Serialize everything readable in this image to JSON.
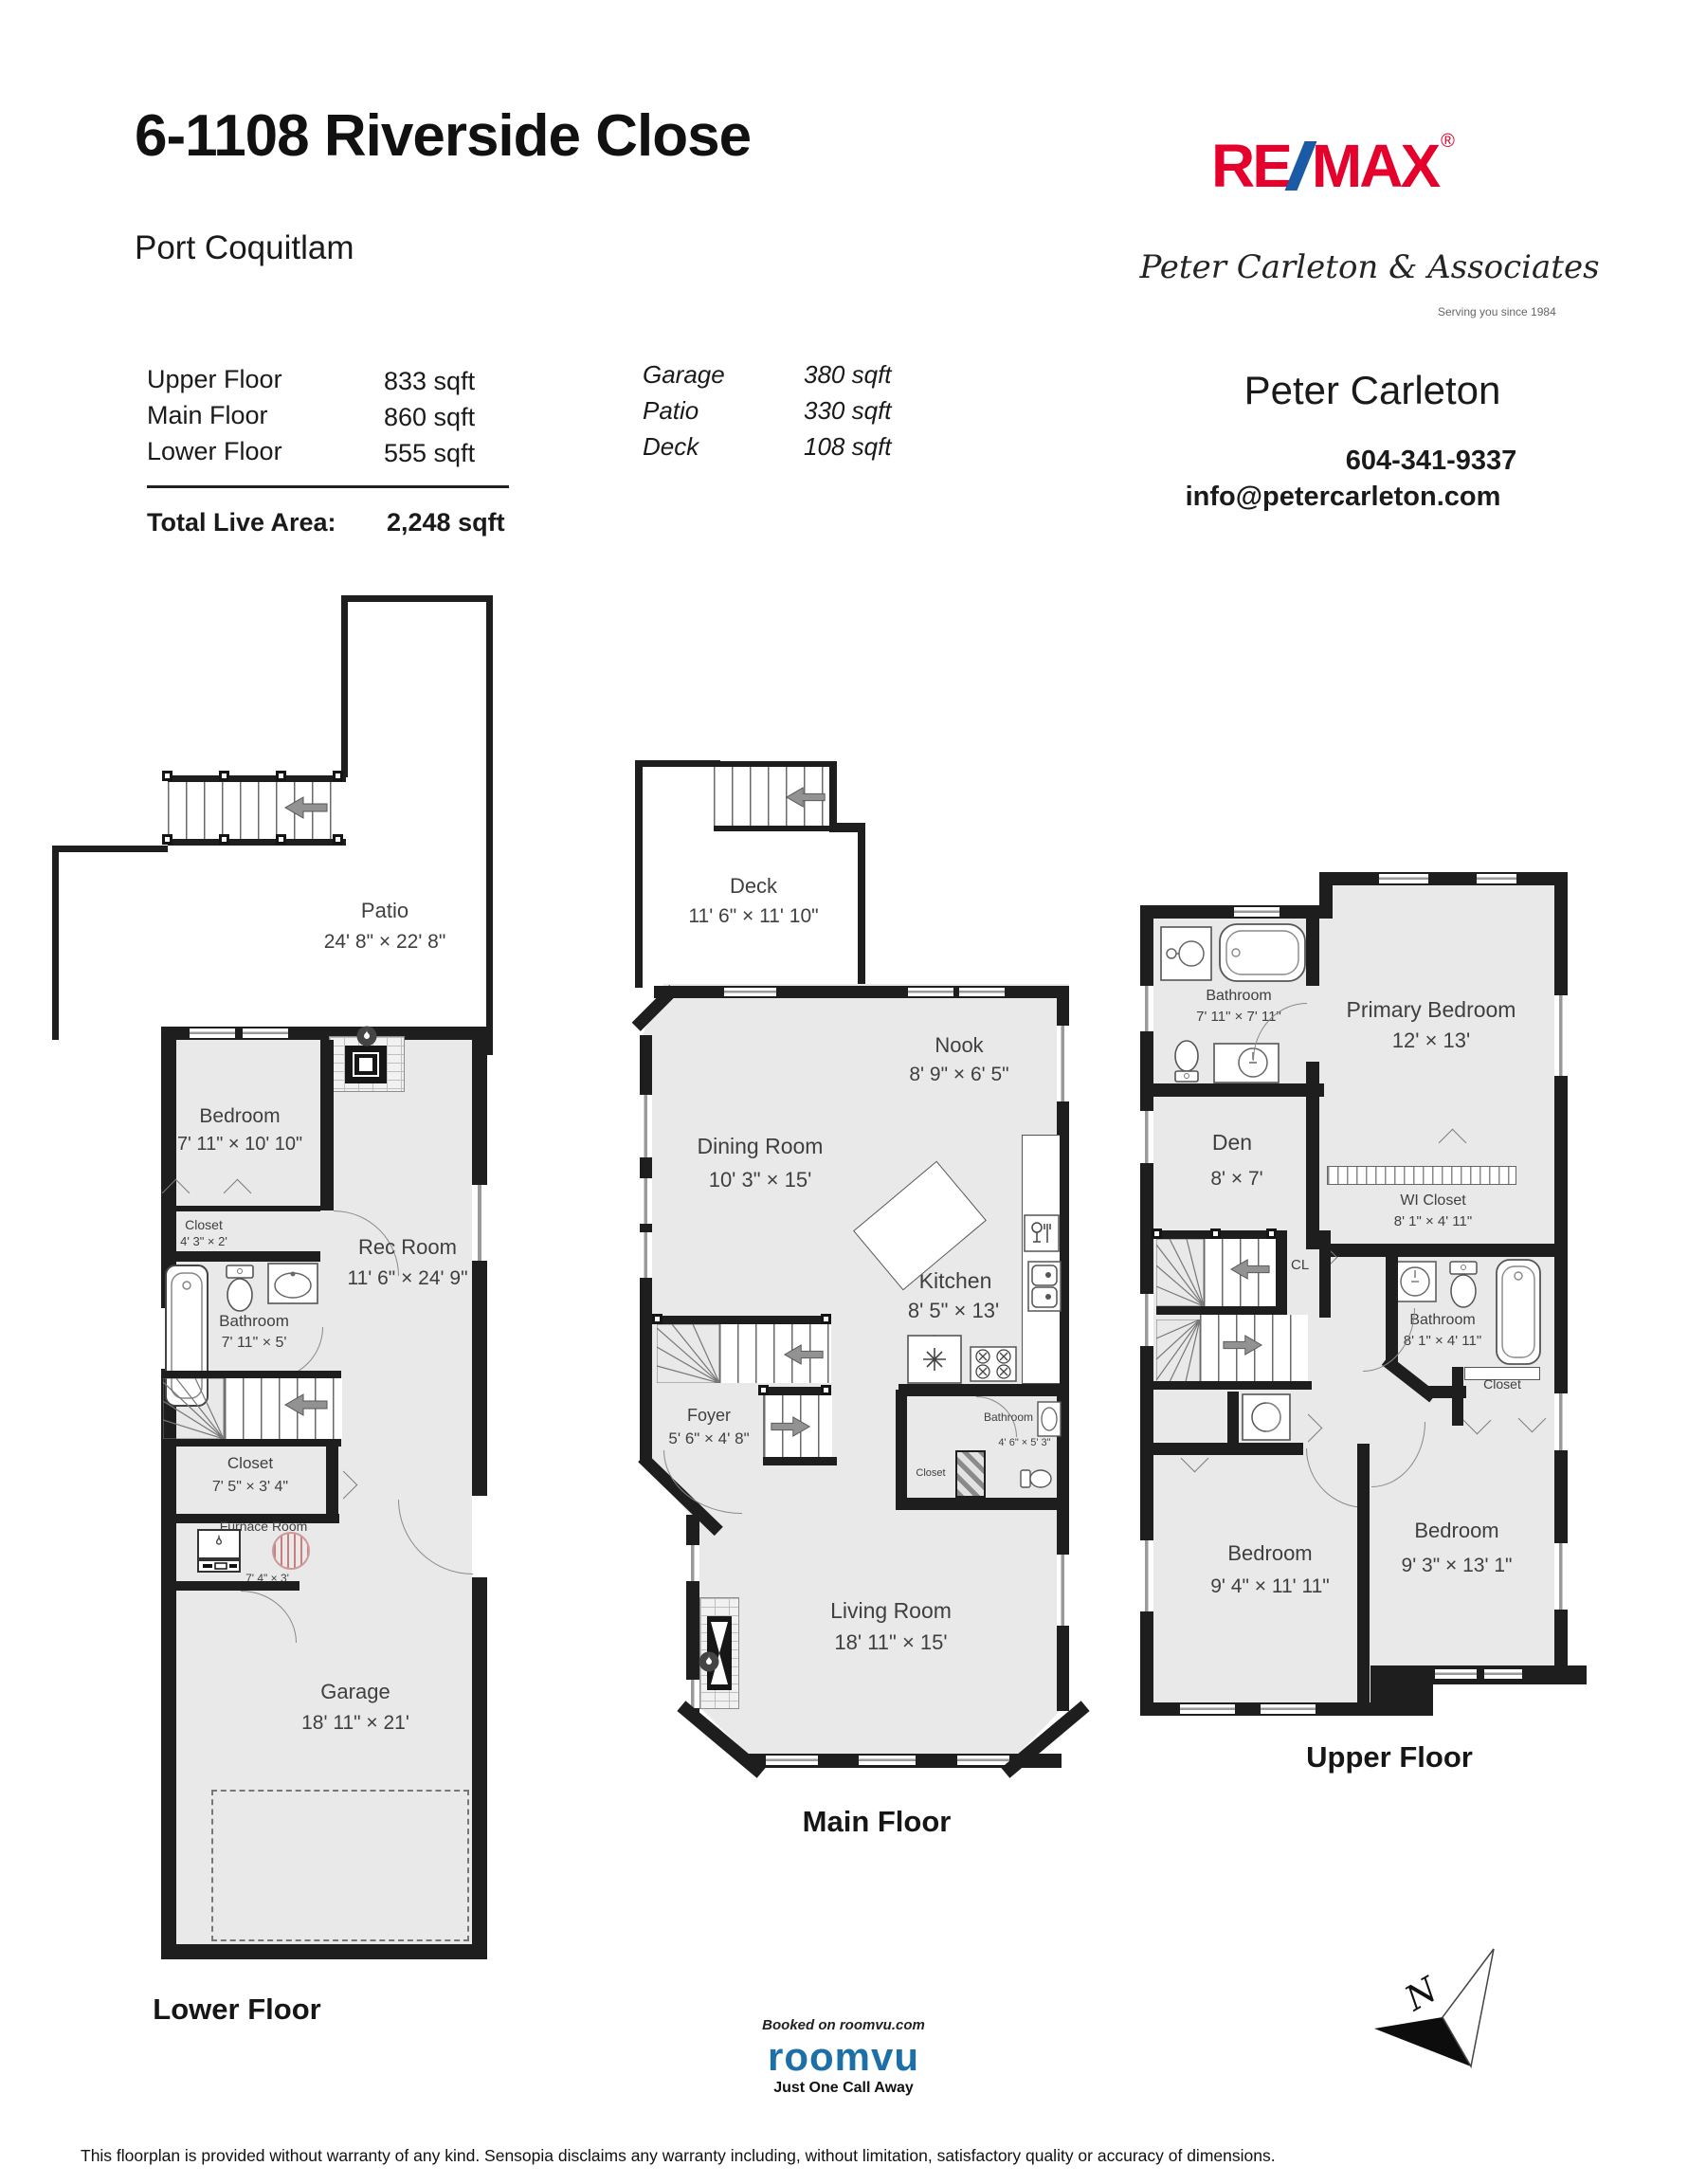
{
  "header": {
    "title": "6-1108 Riverside Close",
    "city": "Port Coquitlam",
    "area_rows_left": [
      {
        "label": "Upper Floor",
        "value": "833 sqft"
      },
      {
        "label": "Main Floor",
        "value": "860 sqft"
      },
      {
        "label": "Lower Floor",
        "value": "555 sqft"
      }
    ],
    "area_rows_right": [
      {
        "label": "Garage",
        "value": "380 sqft"
      },
      {
        "label": "Patio",
        "value": "330 sqft"
      },
      {
        "label": "Deck",
        "value": "108 sqft"
      }
    ],
    "total_label": "Total Live Area:",
    "total_value": "2,248 sqft"
  },
  "brand": {
    "remax_re": "RE",
    "remax_max": "MAX",
    "registered": "®",
    "signature": "Peter Carleton & Associates",
    "signature_tagline": "Serving you since 1984",
    "agent_name": "Peter Carleton",
    "agent_phone": "604-341-9337",
    "agent_email": "info@petercarleton.com",
    "colors": {
      "remax_red": "#e4012c",
      "remax_blue": "#1b5ba5",
      "roomvu_blue": "#1d6fa8"
    }
  },
  "floors": {
    "lower": {
      "label": "Lower Floor",
      "rooms": [
        {
          "name": "Patio",
          "dims": "24' 8\" × 22' 8\""
        },
        {
          "name": "Bedroom",
          "dims": "7' 11\" × 10' 10\""
        },
        {
          "name": "Closet",
          "dims": "4' 3\" × 2'"
        },
        {
          "name": "Rec Room",
          "dims": "11' 6\" × 24' 9\""
        },
        {
          "name": "Bathroom",
          "dims": "7' 11\" × 5'"
        },
        {
          "name": "Closet",
          "dims": "7' 5\" × 3' 4\""
        },
        {
          "name": "Furnace Room",
          "dims": "7' 4\" × 3'"
        },
        {
          "name": "Garage",
          "dims": "18' 11\" × 21'"
        }
      ]
    },
    "main": {
      "label": "Main Floor",
      "rooms": [
        {
          "name": "Deck",
          "dims": "11' 6\" × 11' 10\""
        },
        {
          "name": "Nook",
          "dims": "8' 9\" × 6' 5\""
        },
        {
          "name": "Dining Room",
          "dims": "10' 3\" × 15'"
        },
        {
          "name": "Kitchen",
          "dims": "8' 5\" × 13'"
        },
        {
          "name": "Foyer",
          "dims": "5' 6\" × 4' 8\""
        },
        {
          "name": "Bathroom",
          "dims": "4' 6\" × 5' 3\""
        },
        {
          "name": "Closet",
          "dims": ""
        },
        {
          "name": "Living Room",
          "dims": "18' 11\" × 15'"
        }
      ]
    },
    "upper": {
      "label": "Upper Floor",
      "rooms": [
        {
          "name": "Bathroom",
          "dims": "7' 11\" × 7' 11\""
        },
        {
          "name": "Primary Bedroom",
          "dims": "12' × 13'"
        },
        {
          "name": "Den",
          "dims": "8' × 7'"
        },
        {
          "name": "WI Closet",
          "dims": "8' 1\" × 4' 11\""
        },
        {
          "name": "CL",
          "dims": ""
        },
        {
          "name": "Bathroom",
          "dims": "8' 1\" × 4' 11\""
        },
        {
          "name": "Closet",
          "dims": ""
        },
        {
          "name": "Bedroom",
          "dims": "9' 4\" × 11' 11\""
        },
        {
          "name": "Bedroom",
          "dims": "9' 3\" × 13' 1\""
        }
      ]
    }
  },
  "footer": {
    "booked": "Booked on roomvu.com",
    "roomvu": "roomvu",
    "tagline": "Just One Call Away",
    "north": "N",
    "disclaimer": "This floorplan is provided without warranty of any kind. Sensopia disclaims any warranty including, without limitation, satisfactory quality or accuracy of dimensions."
  }
}
